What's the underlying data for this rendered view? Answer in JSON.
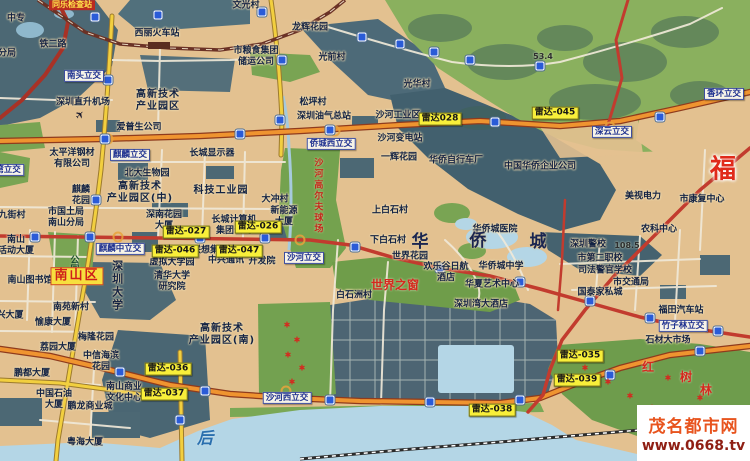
{
  "watermark": {
    "site_name": "茂名都市网",
    "url": "www.0668.tv"
  },
  "palette": {
    "urban_tan": "#e3c190",
    "dark_slate": "#4c6874",
    "park_green": "#79a453",
    "mountain_green": "#8ab05e",
    "water_blue": "#b4d6e6",
    "radar_bg": "#f8ef3a",
    "road_orange": "#ef9430",
    "road_red": "#c23b2e",
    "road_yellow": "#f2cf3f",
    "district_red": "#cf1f1a"
  },
  "radars": [
    {
      "label": "雷达028",
      "x": 440,
      "y": 119
    },
    {
      "label": "雷达-045",
      "x": 555,
      "y": 113
    },
    {
      "label": "雷达-027",
      "x": 186,
      "y": 232
    },
    {
      "label": "雷达-026",
      "x": 258,
      "y": 227
    },
    {
      "label": "雷达-046",
      "x": 175,
      "y": 251
    },
    {
      "label": "雷达-047",
      "x": 239,
      "y": 251
    },
    {
      "label": "雷达-036",
      "x": 168,
      "y": 369
    },
    {
      "label": "雷达-037",
      "x": 164,
      "y": 394
    },
    {
      "label": "雷达-038",
      "x": 492,
      "y": 410
    },
    {
      "label": "雷达-039",
      "x": 577,
      "y": 380
    },
    {
      "label": "雷达-035",
      "x": 580,
      "y": 356
    }
  ],
  "interchanges": [
    {
      "n": "南头立交",
      "x": 84,
      "y": 76
    },
    {
      "n": "麒麟立交",
      "x": 130,
      "y": 155
    },
    {
      "n": "麒麟中立交",
      "x": 120,
      "y": 249
    },
    {
      "n": "沙河立交",
      "x": 304,
      "y": 258
    },
    {
      "n": "侨城西立交",
      "x": 331,
      "y": 144
    },
    {
      "n": "深云立交",
      "x": 612,
      "y": 132
    },
    {
      "n": "香环立交",
      "x": 724,
      "y": 94
    },
    {
      "n": "竹子林立交",
      "x": 683,
      "y": 326
    },
    {
      "n": "沙河西立交",
      "x": 287,
      "y": 398
    },
    {
      "n": "湾立交",
      "x": 8,
      "y": 170
    }
  ],
  "labels": [
    {
      "n": "同乐检查站",
      "x": 72,
      "y": 5,
      "c": "banner"
    },
    {
      "n": "中专",
      "x": 16,
      "y": 19
    },
    {
      "n": "铁二路",
      "x": 53,
      "y": 45
    },
    {
      "n": "分局",
      "x": 7,
      "y": 54
    },
    {
      "n": "西丽火车站",
      "x": 157,
      "y": 34
    },
    {
      "n": "文光村",
      "x": 246,
      "y": 6
    },
    {
      "n": "市粮食集团\n储运公司",
      "x": 256,
      "y": 57
    },
    {
      "n": "龙辉花园",
      "x": 310,
      "y": 28
    },
    {
      "n": "光前村",
      "x": 332,
      "y": 58
    },
    {
      "n": "光华村",
      "x": 417,
      "y": 85
    },
    {
      "n": "松坪村",
      "x": 313,
      "y": 103
    },
    {
      "n": "深圳直升机场",
      "x": 83,
      "y": 103
    },
    {
      "n": "高新技术\n产业园区",
      "x": 158,
      "y": 101,
      "c": "pl lg"
    },
    {
      "n": "爱普生公司",
      "x": 139,
      "y": 128
    },
    {
      "n": "深圳油气总站",
      "x": 324,
      "y": 117
    },
    {
      "n": "沙河工业区",
      "x": 398,
      "y": 116
    },
    {
      "n": "沙河变电站",
      "x": 400,
      "y": 139
    },
    {
      "n": "一辉花园",
      "x": 399,
      "y": 158
    },
    {
      "n": "华侨自行车厂",
      "x": 456,
      "y": 161
    },
    {
      "n": "中国华侨企业公司",
      "x": 540,
      "y": 167
    },
    {
      "n": "美视电力",
      "x": 643,
      "y": 197
    },
    {
      "n": "市康复中心",
      "x": 702,
      "y": 200
    },
    {
      "n": "农科中心",
      "x": 659,
      "y": 230
    },
    {
      "n": "深圳警校",
      "x": 588,
      "y": 245
    },
    {
      "n": "108.5",
      "x": 627,
      "y": 246,
      "c": "elev"
    },
    {
      "n": "53.4",
      "x": 543,
      "y": 57,
      "c": "elev"
    },
    {
      "n": "市第二职校",
      "x": 600,
      "y": 259
    },
    {
      "n": "司法警官学校",
      "x": 605,
      "y": 271
    },
    {
      "n": "市交通局",
      "x": 631,
      "y": 283
    },
    {
      "n": "国泰家私城",
      "x": 600,
      "y": 293
    },
    {
      "n": "福田汽车站",
      "x": 681,
      "y": 311
    },
    {
      "n": "石材大市场",
      "x": 668,
      "y": 341
    },
    {
      "n": "太平洋钢材\n有限公司",
      "x": 72,
      "y": 159
    },
    {
      "n": "麒麟\n花园",
      "x": 81,
      "y": 196
    },
    {
      "n": "市国土局\n南山分局",
      "x": 66,
      "y": 218
    },
    {
      "n": "九街村",
      "x": 12,
      "y": 216
    },
    {
      "n": "南山\n活动大厦",
      "x": 16,
      "y": 246
    },
    {
      "n": "北大生物园",
      "x": 147,
      "y": 174
    },
    {
      "n": "高新技术\n产业园区(中)",
      "x": 140,
      "y": 193,
      "c": "pl lg"
    },
    {
      "n": "科技工业园",
      "x": 221,
      "y": 191,
      "c": "pl lg"
    },
    {
      "n": "长城显示器",
      "x": 212,
      "y": 154
    },
    {
      "n": "深南花园\n大厦",
      "x": 164,
      "y": 221
    },
    {
      "n": "长城计算机\n集团公司",
      "x": 234,
      "y": 226
    },
    {
      "n": "联想集团",
      "x": 210,
      "y": 251
    },
    {
      "n": "中兴通讯",
      "x": 226,
      "y": 261
    },
    {
      "n": "开发院",
      "x": 262,
      "y": 262
    },
    {
      "n": "虚拟大学园",
      "x": 172,
      "y": 263
    },
    {
      "n": "清华大学\n研究院",
      "x": 172,
      "y": 282
    },
    {
      "n": "大冲村",
      "x": 275,
      "y": 200
    },
    {
      "n": "新能源\n大厦",
      "x": 284,
      "y": 217
    },
    {
      "n": "上白石村",
      "x": 390,
      "y": 211
    },
    {
      "n": "下白石村",
      "x": 388,
      "y": 241
    },
    {
      "n": "世界花园",
      "x": 410,
      "y": 257
    },
    {
      "n": "华侨城医院",
      "x": 495,
      "y": 230
    },
    {
      "n": "华侨城中学",
      "x": 501,
      "y": 267
    },
    {
      "n": "华夏艺术中心",
      "x": 492,
      "y": 285
    },
    {
      "n": "欢乐谷日航\n酒店",
      "x": 446,
      "y": 273
    },
    {
      "n": "深圳湾大酒店",
      "x": 481,
      "y": 305
    },
    {
      "n": "白石洲村",
      "x": 354,
      "y": 296
    },
    {
      "n": "世界之窗",
      "x": 395,
      "y": 285,
      "c": "mang"
    },
    {
      "n": "南山图书馆",
      "x": 30,
      "y": 281
    },
    {
      "n": "南苑新村",
      "x": 71,
      "y": 308
    },
    {
      "n": "愉康大厦",
      "x": 53,
      "y": 323
    },
    {
      "n": "荔园大厦",
      "x": 58,
      "y": 348
    },
    {
      "n": "兴大厦",
      "x": 10,
      "y": 316
    },
    {
      "n": "梅隆花园",
      "x": 96,
      "y": 338
    },
    {
      "n": "中信海滨\n花园",
      "x": 101,
      "y": 362
    },
    {
      "n": "鹏都大厦",
      "x": 32,
      "y": 374
    },
    {
      "n": "中国石油\n大厦",
      "x": 54,
      "y": 400
    },
    {
      "n": "鹏龙商业城",
      "x": 90,
      "y": 407
    },
    {
      "n": "南山商业\n文化中心",
      "x": 124,
      "y": 393
    },
    {
      "n": "粤海大厦",
      "x": 85,
      "y": 443
    },
    {
      "n": "高新技术\n产业园区(南)",
      "x": 222,
      "y": 335,
      "c": "pl lg"
    },
    {
      "n": "南山区",
      "x": 77,
      "y": 276,
      "c": "district"
    },
    {
      "n": "福",
      "x": 723,
      "y": 170,
      "c": "giant"
    },
    {
      "n": "华",
      "x": 420,
      "y": 242,
      "c": "octc"
    },
    {
      "n": "侨",
      "x": 478,
      "y": 241,
      "c": "octc"
    },
    {
      "n": "城",
      "x": 538,
      "y": 242,
      "c": "octc"
    },
    {
      "n": "红",
      "x": 648,
      "y": 367,
      "c": "mang"
    },
    {
      "n": "树",
      "x": 686,
      "y": 377,
      "c": "mang"
    },
    {
      "n": "林",
      "x": 706,
      "y": 390,
      "c": "mang"
    },
    {
      "n": "后",
      "x": 205,
      "y": 438,
      "c": "sea"
    },
    {
      "n": "深圳大学",
      "x": 117,
      "y": 286,
      "c": "vert vu"
    },
    {
      "n": "公园",
      "x": 73,
      "y": 264,
      "c": "vert vg"
    },
    {
      "n": "沙河高尔夫球场",
      "x": 317,
      "y": 196,
      "c": "vert vr"
    }
  ],
  "shields": [
    [
      95,
      17
    ],
    [
      158,
      15
    ],
    [
      262,
      12
    ],
    [
      362,
      37
    ],
    [
      400,
      44
    ],
    [
      434,
      52
    ],
    [
      470,
      60
    ],
    [
      540,
      66
    ],
    [
      105,
      139
    ],
    [
      240,
      134
    ],
    [
      330,
      130
    ],
    [
      495,
      122
    ],
    [
      660,
      117
    ],
    [
      35,
      237
    ],
    [
      90,
      237
    ],
    [
      200,
      238
    ],
    [
      265,
      238
    ],
    [
      355,
      247
    ],
    [
      440,
      268
    ],
    [
      520,
      282
    ],
    [
      590,
      301
    ],
    [
      650,
      318
    ],
    [
      718,
      331
    ],
    [
      120,
      372
    ],
    [
      205,
      391
    ],
    [
      330,
      400
    ],
    [
      430,
      402
    ],
    [
      520,
      400
    ],
    [
      610,
      375
    ],
    [
      700,
      351
    ],
    [
      108,
      80
    ],
    [
      96,
      200
    ],
    [
      282,
      60
    ],
    [
      280,
      120
    ],
    [
      180,
      420
    ]
  ],
  "veg_markers": [
    [
      287,
      325
    ],
    [
      297,
      340
    ],
    [
      288,
      355
    ],
    [
      302,
      368
    ],
    [
      292,
      382
    ],
    [
      585,
      368
    ],
    [
      608,
      382
    ],
    [
      630,
      396
    ],
    [
      652,
      408
    ],
    [
      668,
      378
    ],
    [
      700,
      398
    ],
    [
      716,
      412
    ]
  ],
  "icons": [
    {
      "n": "airplane",
      "x": 80,
      "y": 115
    }
  ]
}
